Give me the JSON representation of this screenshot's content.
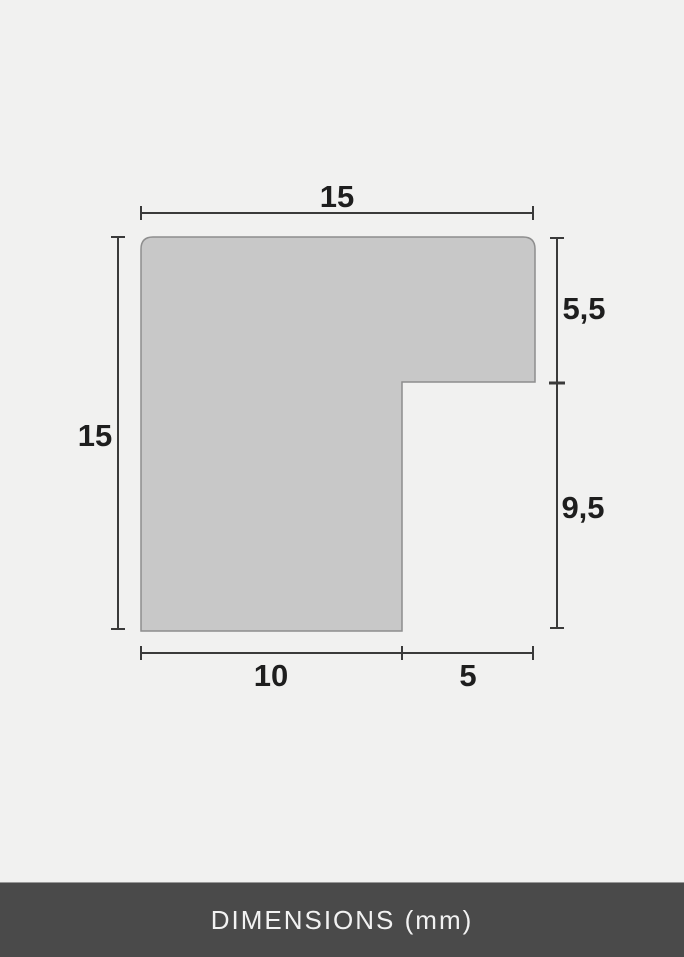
{
  "diagram": {
    "shape_name": "frame-moulding-profile-cross-section",
    "unit": "mm",
    "labels": {
      "width_total": "15",
      "height_total": "15",
      "right_top": "5,5",
      "right_bottom": "9,5",
      "bottom_left": "10",
      "bottom_right": "5"
    },
    "measurements_mm": {
      "total_width": 15,
      "total_height": 15,
      "top_arm_thickness": 5.5,
      "notch_height": 9.5,
      "bottom_leg_width": 10,
      "notch_width": 5
    },
    "colors": {
      "background": "#f1f1f0",
      "shape_fill": "#c8c8c8",
      "shape_stroke": "#8e8e8e",
      "dimension_line": "#3a3a3a",
      "label_text": "#1e1e1e",
      "footer_bg": "#4a4a4a",
      "footer_text": "#f2f2f2"
    }
  },
  "footer": {
    "label": "DIMENSIONS (mm)"
  }
}
